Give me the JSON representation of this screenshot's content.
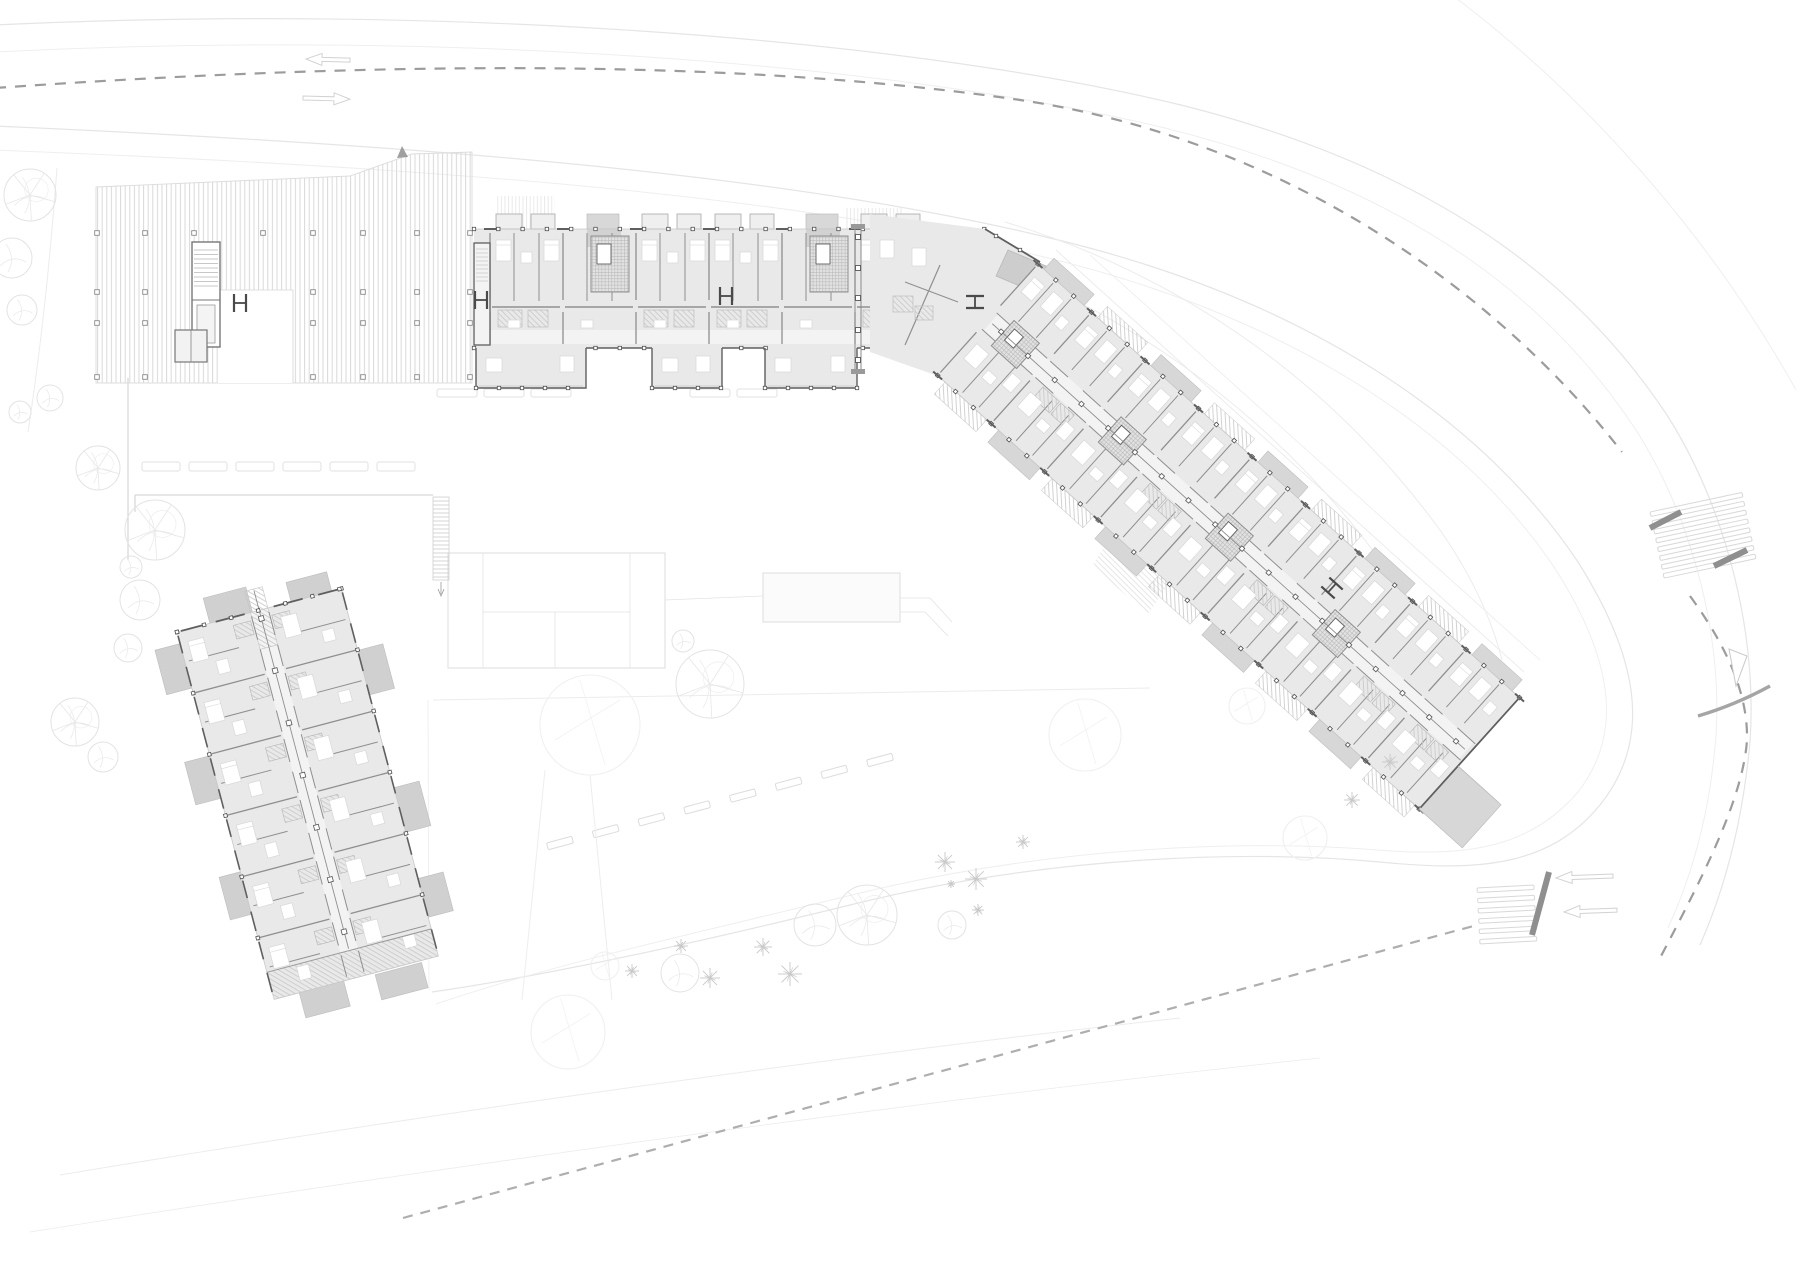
{
  "scene": {
    "label": "architectural-ground-floor-site-plan",
    "width": 1800,
    "height": 1273,
    "background": "#ffffff"
  },
  "palette": {
    "road_edge": "#e5e5e5",
    "road_edge_faint": "#efefef",
    "terrain": "#ececec",
    "centerline": "#9c9c9c",
    "boundary": "#aeaeae",
    "wall_dark": "#5f5f5f",
    "wall_mid": "#8f8f8f",
    "wall_light": "#bdbdbd",
    "room_fill": "#e9e9e9",
    "corridor_fill": "#f3f3f3",
    "slab_fill": "#d7d7d7",
    "slab_dark": "#cdcdcd",
    "canopy_fill": "#cdcdcd",
    "hatch_line": "#c6c6c6",
    "stripe_line": "#d9d9d9",
    "furniture_stroke": "#d8d8d8",
    "tree_stroke": "#e3e3e3",
    "shrub_stroke": "#c9c9c9",
    "court_stroke": "#dedede",
    "stopbar": "#8f8f8f",
    "pier": "#4f4f4f"
  },
  "roads": {
    "edges": [
      {
        "name": "outer-edge-1",
        "d": "M -5,25 C 430,4 900,36 1185,106 C 1460,176 1590,300 1667,415 C 1730,515 1757,640 1750,742 C 1742,830 1722,895 1700,945",
        "w": 1.2,
        "c": "road_edge"
      },
      {
        "name": "outer-edge-2",
        "d": "M -5,52 C 430,30 880,60 1165,128 C 1430,194 1560,315 1636,430 C 1695,523 1722,640 1716,735 C 1710,818 1690,880 1668,928",
        "w": 1,
        "c": "road_edge_faint"
      },
      {
        "name": "outer-verge",
        "d": "M 1452,-5 C 1585,95 1710,235 1796,390",
        "w": 1,
        "c": "road_edge_faint"
      },
      {
        "name": "inner-edge-1",
        "d": "M -5,126 C 400,144 780,172 1050,238 C 1320,302 1490,430 1578,562 C 1645,668 1648,745 1600,805 C 1550,866 1480,872 1380,862 C 1250,850 1050,855 850,905 C 700,942 550,975 432,992",
        "w": 1.2,
        "c": "road_edge"
      },
      {
        "name": "inner-edge-2",
        "d": "M -5,150 C 400,166 780,192 1040,256 C 1300,318 1470,440 1556,570 C 1618,668 1620,738 1578,792 C 1532,846 1470,858 1378,850 C 1250,840 1060,845 860,893 C 710,930 556,963 436,1004",
        "w": 1,
        "c": "road_edge_faint"
      }
    ],
    "terrain": [
      {
        "d": "M 1005,222 C 1180,275 1330,380 1440,530 C 1472,576 1492,620 1502,660",
        "w": 1
      },
      {
        "d": "M 955,250 C 1120,305 1270,410 1380,560 C 1406,600 1420,640 1430,672",
        "w": 1
      },
      {
        "d": "M 1056,250 L 1524,672",
        "w": 1
      },
      {
        "d": "M 1090,255 L 1540,660",
        "w": 0.8
      },
      {
        "d": "M 60,1175 C 420,1115 820,1058 1180,1018",
        "w": 1
      },
      {
        "d": "M 30,1232 C 420,1170 920,1100 1320,1058",
        "w": 0.8
      },
      {
        "d": "M 433,700 L 1150,688",
        "w": 1
      },
      {
        "d": "M 428,700 L 429,990",
        "w": 0.8
      },
      {
        "d": "M 57,168 C 50,260 42,340 28,432",
        "w": 1
      }
    ],
    "wedges": [
      [
        [
          1120,
          522
        ],
        [
          1178,
          570
        ],
        [
          1148,
          614
        ],
        [
          1092,
          566
        ]
      ]
    ],
    "centerline": {
      "w": 2.2,
      "dash": "11 9",
      "segments": [
        "M -5,88 C 420,58 760,62 1020,100 C 1290,140 1500,295 1622,452",
        "M 1690,596 C 1728,648 1748,695 1747,740 C 1743,800 1700,882 1660,958"
      ]
    },
    "boundary": {
      "w": 2.2,
      "dash": "10 8",
      "d": "M 403,1218 L 1477,925"
    },
    "arrows": [
      {
        "x": 306,
        "y": 59,
        "len": 44,
        "dir": -1,
        "rot": 1.5
      },
      {
        "x": 303,
        "y": 98,
        "len": 47,
        "dir": 1,
        "rot": 1.5
      },
      {
        "x": 1556,
        "y": 878,
        "len": 57,
        "dir": -1,
        "rot": -2
      },
      {
        "x": 1564,
        "y": 912,
        "len": 53,
        "dir": -1,
        "rot": -2
      }
    ],
    "crosswalks": [
      {
        "x": 1650,
        "y": 512,
        "rot": -12,
        "n": 8,
        "len": 94,
        "step": 9,
        "h": 4.6
      },
      {
        "x": 1477,
        "y": 888,
        "rot": -3,
        "n": 6,
        "len": 57,
        "step": 10.3,
        "h": 4.5
      }
    ],
    "stop_bars": [
      [
        1650,
        528,
        1681,
        512
      ],
      [
        1714,
        566,
        1747,
        550
      ],
      [
        1532,
        935,
        1549,
        872
      ]
    ],
    "island": [
      [
        1729,
        649
      ],
      [
        1747,
        656
      ],
      [
        1736,
        686
      ]
    ],
    "curbs": [
      "M 1698,716 C 1725,708 1748,698 1770,686"
    ],
    "parking_rows": [
      {
        "y": 462,
        "h": 9,
        "bays": [
          [
            142,
            38
          ],
          [
            189,
            38
          ],
          [
            236,
            38
          ],
          [
            283,
            38
          ],
          [
            330,
            38
          ],
          [
            377,
            38
          ]
        ]
      },
      {
        "y": 389,
        "h": 8,
        "bays": [
          [
            437,
            40
          ],
          [
            484,
            40
          ],
          [
            531,
            40
          ],
          [
            690,
            40
          ],
          [
            737,
            40
          ]
        ]
      }
    ],
    "parking_diag": {
      "x1": 560,
      "y1": 843,
      "x2": 880,
      "y2": 760,
      "n": 8,
      "len": 26,
      "h": 7,
      "rot": -15
    }
  },
  "pergola": {
    "outline": "M 96,187 L 350,176 L 412,154 L 472,152 L 472,383 L 96,383 Z",
    "cols_x": [
      97,
      145,
      194,
      263,
      313,
      363,
      417,
      470
    ],
    "cols_y": [
      233,
      292,
      323,
      377
    ],
    "stair": [
      192,
      242,
      28,
      105
    ],
    "rooms": [
      175,
      330,
      32,
      32
    ],
    "clear": [
      218,
      290,
      75,
      93
    ],
    "flag": [
      [
        397,
        158
      ],
      [
        402,
        146
      ],
      [
        408,
        157
      ]
    ]
  },
  "north_wing": {
    "x0": 474,
    "cap_w": 16,
    "mod_x": 490,
    "mod_w": 73,
    "mods": 6,
    "end": 985,
    "top": 229,
    "tab_top": 214,
    "mid": 307,
    "bottom": 348,
    "cores": [
      1,
      4
    ],
    "annexes": [
      [
        476,
        110
      ],
      [
        652,
        70
      ],
      [
        765,
        92
      ]
    ],
    "annex_bottom": 388,
    "canopies": [
      [
        495,
        196,
        60,
        33
      ],
      [
        846,
        208,
        56,
        21
      ]
    ],
    "colonnade": {
      "x": 855,
      "y1": 228,
      "y2": 370,
      "piers": [
        237,
        268,
        298,
        330,
        360
      ]
    }
  },
  "elbow": {
    "base": "M 870,214 L 985,229 L 1040,262 L 938,376 L 870,352 Z",
    "ne_wall": "M 985,229 L 1040,262",
    "canopy": [
      [
        1008,
        250
      ],
      [
        1046,
        266
      ],
      [
        1034,
        292
      ],
      [
        996,
        276
      ]
    ]
  },
  "east_wing": {
    "ox": 1038,
    "oy": 264,
    "angle": 42,
    "len": 648,
    "wid": 150,
    "mod_w": 72,
    "tip_slab": [
      648,
      92,
      58,
      58
    ]
  },
  "south_tower": {
    "ox": 177,
    "oy": 632,
    "angle": -14.8,
    "w": 170,
    "h": 380,
    "rows": 6,
    "row_h": 63.3,
    "slabs": [
      [
        34,
        -26,
        44,
        28
      ],
      [
        118,
        -20,
        42,
        24
      ],
      [
        -26,
        12,
        26,
        46
      ],
      [
        -26,
        128,
        26,
        44
      ],
      [
        170,
        64,
        26,
        46
      ],
      [
        170,
        206,
        26,
        46
      ],
      [
        170,
        300,
        26,
        40
      ],
      [
        -22,
        248,
        24,
        44
      ],
      [
        26,
        380,
        46,
        26
      ],
      [
        104,
        382,
        48,
        26
      ]
    ],
    "terrace": [
      0,
      352,
      170,
      28
    ]
  },
  "courtyard": {
    "court": {
      "x": 448,
      "y": 553,
      "w": 217,
      "h": 115,
      "vlines": [
        483,
        630
      ],
      "hline": 612,
      "vline2": 555
    },
    "pool": {
      "x": 763,
      "y": 573,
      "w": 137,
      "h": 49
    },
    "links": [
      "M 665,600 L 763,596",
      "M 900,598 L 930,598 L 952,622",
      "M 900,612 L 925,612 L 948,636"
    ],
    "stairs": {
      "x": 433,
      "y": 497,
      "w": 16,
      "h": 83
    },
    "walls": [
      "M 135,495 L 433,495",
      "M 135,495 L 135,512",
      "M 128,378 L 128,560"
    ]
  },
  "landscape": {
    "trees": [
      [
        30,
        195,
        26,
        1
      ],
      [
        12,
        258,
        20,
        0
      ],
      [
        22,
        310,
        15,
        0
      ],
      [
        50,
        398,
        13,
        0
      ],
      [
        20,
        412,
        11,
        0
      ],
      [
        98,
        468,
        22,
        1
      ],
      [
        155,
        530,
        30,
        1
      ],
      [
        131,
        567,
        11,
        0
      ],
      [
        140,
        600,
        20,
        0
      ],
      [
        128,
        648,
        14,
        0
      ],
      [
        75,
        722,
        24,
        1
      ],
      [
        103,
        757,
        15,
        0
      ],
      [
        683,
        641,
        11,
        0
      ],
      [
        710,
        684,
        34,
        1
      ],
      [
        605,
        966,
        14,
        2
      ],
      [
        568,
        1032,
        37,
        2
      ],
      [
        815,
        925,
        21,
        0
      ],
      [
        867,
        915,
        30,
        1
      ],
      [
        952,
        925,
        14,
        0
      ],
      [
        680,
        973,
        19,
        0
      ],
      [
        590,
        725,
        50,
        2
      ],
      [
        1085,
        735,
        36,
        2
      ],
      [
        1247,
        706,
        18,
        2
      ],
      [
        1305,
        838,
        22,
        2
      ]
    ],
    "shrubs": [
      [
        763,
        947,
        9
      ],
      [
        790,
        974,
        12
      ],
      [
        710,
        978,
        10
      ],
      [
        681,
        946,
        7
      ],
      [
        632,
        971,
        7
      ],
      [
        945,
        862,
        10
      ],
      [
        976,
        879,
        11
      ],
      [
        951,
        884,
        4
      ],
      [
        978,
        910,
        6
      ],
      [
        1023,
        842,
        7
      ],
      [
        1352,
        800,
        8
      ],
      [
        1390,
        762,
        8
      ]
    ],
    "fork": [
      "M 545,770 L 522,1000",
      "M 590,775 L 612,1000"
    ]
  },
  "symbols": {
    "ibeams": [
      [
        481,
        300,
        90
      ],
      [
        726,
        296,
        90
      ],
      [
        975,
        302,
        0
      ],
      [
        1332,
        588,
        42
      ],
      [
        240,
        303,
        90
      ]
    ]
  }
}
